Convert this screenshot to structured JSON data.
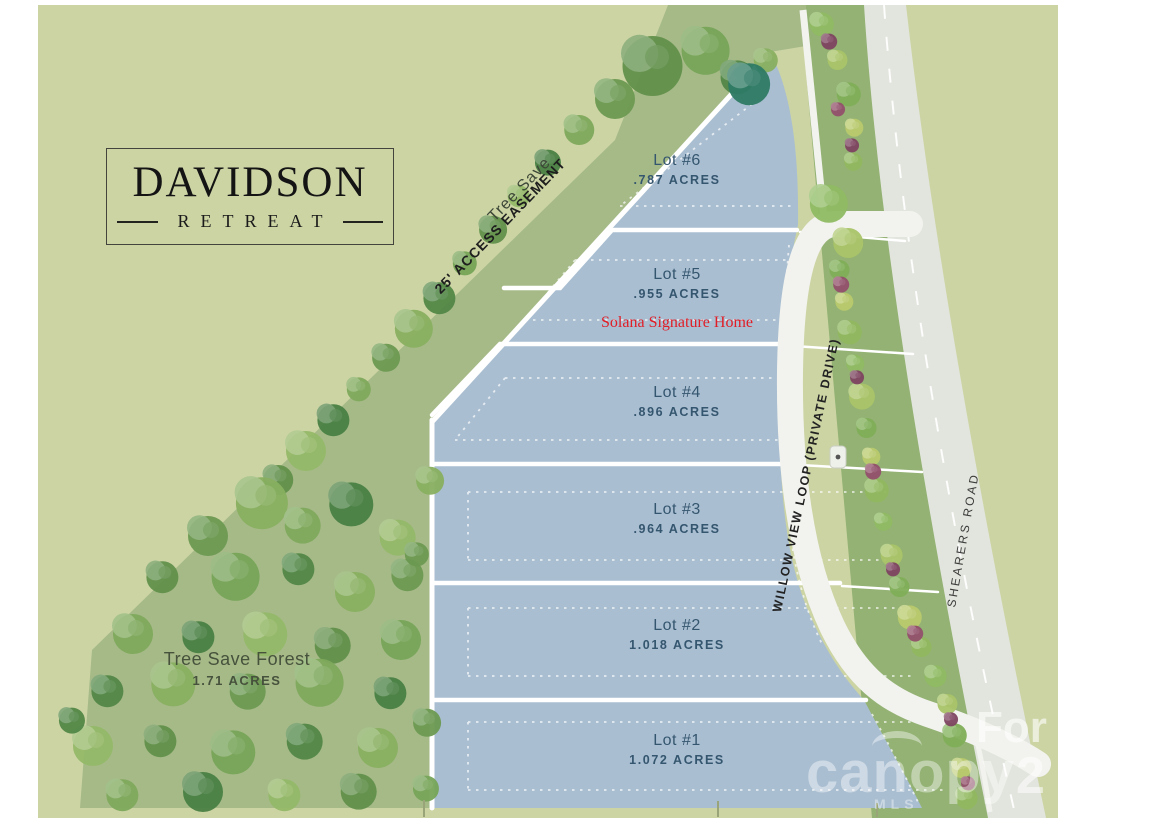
{
  "map": {
    "colors": {
      "green-field": "#ccd4a4",
      "tree-green": "#a6ba88",
      "strip-green": "#93b273",
      "lot-fill": "#a9bed1",
      "road-gray": "#e2e5dd",
      "label-navy": "#35566f",
      "note-red": "#e11d26"
    },
    "logo": {
      "title": "DAVIDSON",
      "subtitle": "RETREAT"
    },
    "easement": {
      "line1": "Tree Save",
      "line2": "25' ACCESS EASEMENT"
    },
    "lots": [
      {
        "id": "lot-6",
        "name": "Lot #6",
        "acres": ".787 ACRES"
      },
      {
        "id": "lot-5",
        "name": "Lot #5",
        "acres": ".955 ACRES"
      },
      {
        "id": "lot-4",
        "name": "Lot #4",
        "acres": ".896 ACRES"
      },
      {
        "id": "lot-3",
        "name": "Lot #3",
        "acres": ".964 ACRES"
      },
      {
        "id": "lot-2",
        "name": "Lot #2",
        "acres": "1.018 ACRES"
      },
      {
        "id": "lot-1",
        "name": "Lot #1",
        "acres": "1.072 ACRES"
      }
    ],
    "builder_note": "Solana Signature Home",
    "forest": {
      "name": "Tree Save Forest",
      "acres": "1.71 ACRES"
    },
    "roads": {
      "loop": "WILLOW VIEW LOOP  (PRIVATE DRIVE)",
      "main": "SHEARERS ROAD"
    },
    "watermark": {
      "brand": "canopy",
      "sub": "MLS",
      "overlay_1": "For",
      "overlay_2": "2"
    }
  }
}
